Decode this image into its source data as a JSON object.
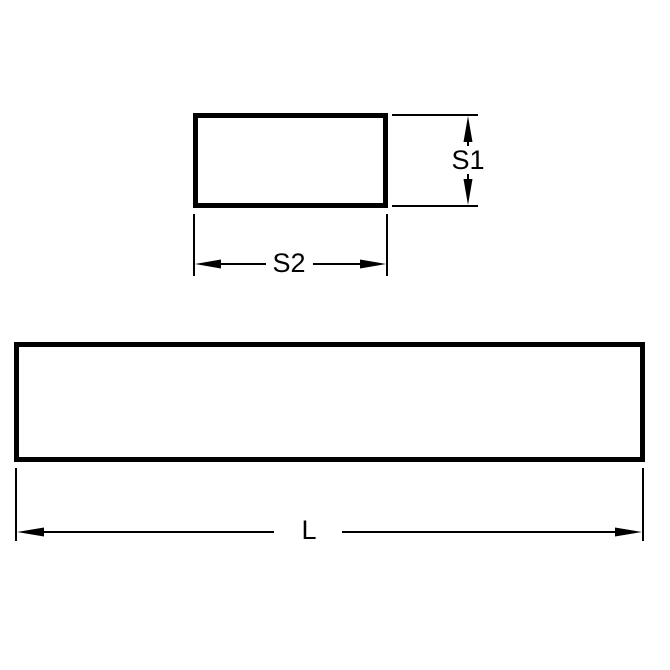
{
  "figure": {
    "description": "Technical dimension drawing of a rectangular bar (keystock): cross-section view with height and width dimensions, and side view with length dimension",
    "colors": {
      "background": "#ffffff",
      "line": "#000000",
      "text": "#000000"
    },
    "cross_section": {
      "shape": "rectangle",
      "dim_height_label": "S1",
      "dim_width_label": "S2"
    },
    "side_view": {
      "shape": "rectangle",
      "dim_length_label": "L"
    },
    "labels": {
      "s1": "S1",
      "s2": "S2",
      "l": "L"
    }
  }
}
